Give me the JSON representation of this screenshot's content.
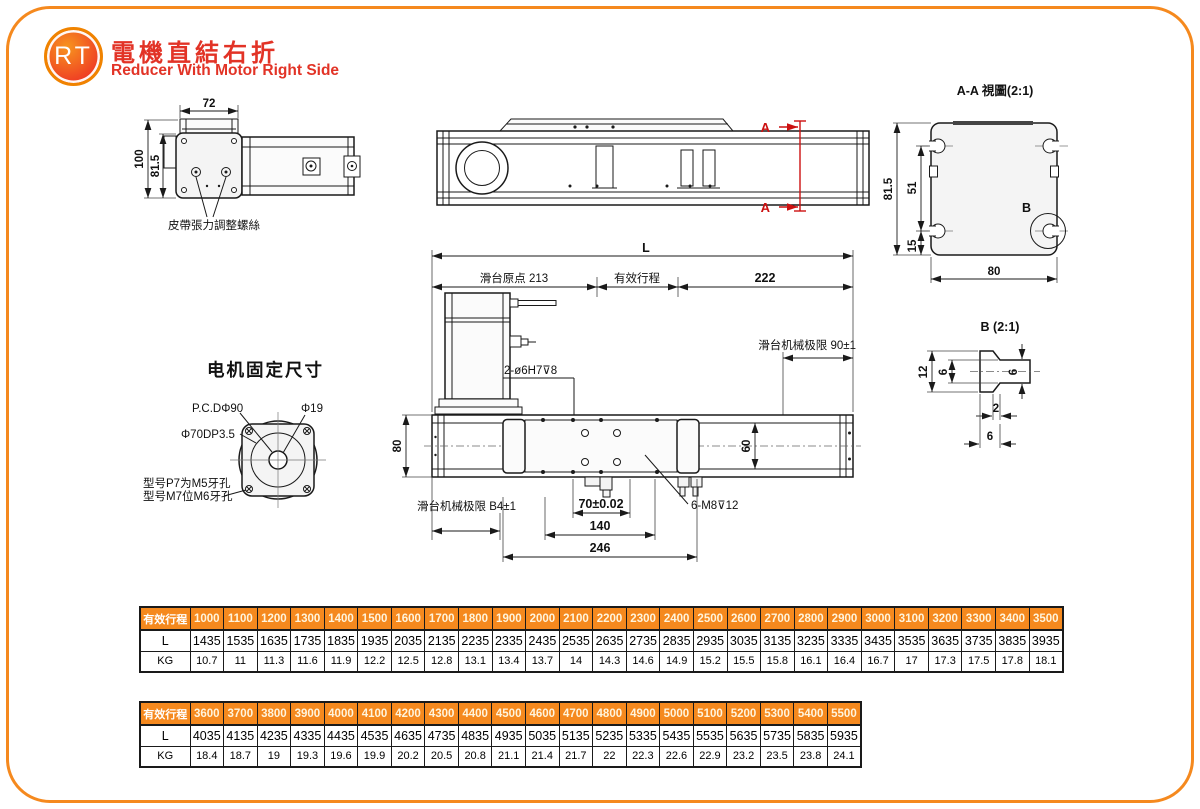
{
  "page": {
    "logo_text": "RT",
    "title_zh": "電機直結右折",
    "title_en": "Reducer With Motor Right Side"
  },
  "colors": {
    "accent_orange": "#F5891E",
    "brand_red": "#E23326",
    "annotation_red": "#CC1111",
    "line_black": "#1A1A1A"
  },
  "front_view": {
    "dim_width": "72",
    "dim_height_outer": "100",
    "dim_height_inner": "81.5",
    "belt_label": "皮帶張力調整螺絲"
  },
  "side_view": {
    "section_marker_top": "A",
    "section_marker_bottom": "A"
  },
  "section_view": {
    "title": "A-A 視圖(2:1)",
    "dim_height": "81.5",
    "dim_slot_span": "51",
    "dim_slot_bottom": "15",
    "dim_width": "80",
    "detail_marker": "B"
  },
  "plan_view": {
    "dim_overall": "L",
    "dim_origin": "滑台原点 213",
    "dim_stroke": "有效行程",
    "dim_right": "222",
    "limit_right": "滑台机械极限 90±1",
    "limit_left": "滑台机械极限 B4±1",
    "pin_holes": "2-ø6H7⊽8",
    "dim_base_height": "80",
    "dim_carriage_width": "60",
    "dim_hole_span": "70±0.02",
    "dim_140": "140",
    "dim_246": "246",
    "tap_holes": "6-M8⊽12"
  },
  "motor_mount": {
    "title": "电机固定尺寸",
    "pcd": "P.C.DΦ90",
    "shaft": "Φ19",
    "spigot": "Φ70DP3.5",
    "note_line1": "型号P7为M5牙孔",
    "note_line2": "型号M7位M6牙孔"
  },
  "detail_b": {
    "title": "B (2:1)",
    "dim_total": "12",
    "dim_head": "6",
    "dim_bar": "6",
    "dim_lip": "2",
    "dim_neck": "6"
  },
  "table1": {
    "header_label": "有效行程",
    "strokes": [
      "1000",
      "1100",
      "1200",
      "1300",
      "1400",
      "1500",
      "1600",
      "1700",
      "1800",
      "1900",
      "2000",
      "2100",
      "2200",
      "2300",
      "2400",
      "2500",
      "2600",
      "2700",
      "2800",
      "2900",
      "3000",
      "3100",
      "3200",
      "3300",
      "3400",
      "3500"
    ],
    "rows": [
      {
        "label": "L",
        "values": [
          "1435",
          "1535",
          "1635",
          "1735",
          "1835",
          "1935",
          "2035",
          "2135",
          "2235",
          "2335",
          "2435",
          "2535",
          "2635",
          "2735",
          "2835",
          "2935",
          "3035",
          "3135",
          "3235",
          "3335",
          "3435",
          "3535",
          "3635",
          "3735",
          "3835",
          "3935"
        ]
      },
      {
        "label": "KG",
        "values": [
          "10.7",
          "11",
          "11.3",
          "11.6",
          "11.9",
          "12.2",
          "12.5",
          "12.8",
          "13.1",
          "13.4",
          "13.7",
          "14",
          "14.3",
          "14.6",
          "14.9",
          "15.2",
          "15.5",
          "15.8",
          "16.1",
          "16.4",
          "16.7",
          "17",
          "17.3",
          "17.5",
          "17.8",
          "18.1"
        ]
      }
    ]
  },
  "table2": {
    "header_label": "有效行程",
    "strokes": [
      "3600",
      "3700",
      "3800",
      "3900",
      "4000",
      "4100",
      "4200",
      "4300",
      "4400",
      "4500",
      "4600",
      "4700",
      "4800",
      "4900",
      "5000",
      "5100",
      "5200",
      "5300",
      "5400",
      "5500"
    ],
    "rows": [
      {
        "label": "L",
        "values": [
          "4035",
          "4135",
          "4235",
          "4335",
          "4435",
          "4535",
          "4635",
          "4735",
          "4835",
          "4935",
          "5035",
          "5135",
          "5235",
          "5335",
          "5435",
          "5535",
          "5635",
          "5735",
          "5835",
          "5935"
        ]
      },
      {
        "label": "KG",
        "values": [
          "18.4",
          "18.7",
          "19",
          "19.3",
          "19.6",
          "19.9",
          "20.2",
          "20.5",
          "20.8",
          "21.1",
          "21.4",
          "21.7",
          "22",
          "22.3",
          "22.6",
          "22.9",
          "23.2",
          "23.5",
          "23.8",
          "24.1"
        ]
      }
    ]
  }
}
